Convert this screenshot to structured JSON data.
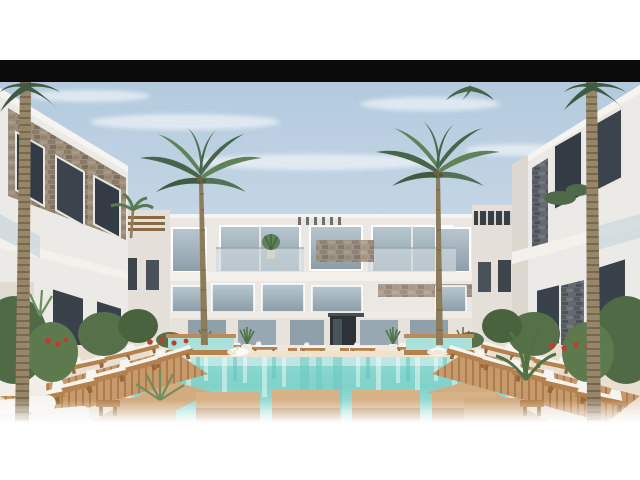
{
  "meta": {
    "kind": "architectural-render-photo",
    "description": "3D architectural rendering of a symmetrical white resort apartment complex around a turquoise swimming pool with wooden deck platforms, white sun loungers, tropical plants and tall palm trees under a pale blue sky. The image is letterboxed: white margins top and bottom and a solid black bar above the photo."
  },
  "palette": {
    "page_bg": "#ffffff",
    "letterbox": "#0b0b0b",
    "sky_top": "#b3cade",
    "sky_bottom": "#dfe8ee",
    "building_white": "#ebe8e3",
    "building_shade": "#dcd7cf",
    "stone_brown": "#9c8d7c",
    "stone_gray": "#5e6268",
    "glass": "#a9b9c3",
    "window_dark": "#333c44",
    "entry_dark": "#2c3237",
    "pool_main": "#7fd2ca",
    "pool_light": "#b9e9e2",
    "deck_wood": "#d3ab80",
    "deck_wood_front": "#bd9166",
    "bench_wood": "#b5824f",
    "ground_sand": "#e9dfd0",
    "cushion_white": "#f6f4ef",
    "palm_green_dark": "#46654a",
    "palm_green": "#5f8257",
    "trunk_brown": "#97876a",
    "flower_red": "#c23b2e"
  },
  "scene": {
    "labels": {
      "page": "letterboxed resort rendering",
      "letterbox_top": "black letterbox bar",
      "sky": "pale blue sky with thin clouds",
      "center_building": "central three-storey white apartment building with glass balconies",
      "left_building": "left white building with brown stone cladding",
      "right_building": "right white building with gray stone accents",
      "pool": "turquoise swimming pool with cascade water features",
      "deck": "wooden stepping platforms over the pool",
      "loungers_left": "fan of white sun loungers on wooden deck, left side",
      "loungers_right": "fan of white sun loungers on wooden deck, right side",
      "loungers_far": "row of sun loungers along the far pool edge",
      "palm_left_edge": "tall palm trunk at left edge",
      "palm_right_edge": "tall palm trunk at right edge",
      "palm_center_left": "palm tree left of building center",
      "palm_center_right": "palm tree right of building center",
      "plants_left": "tropical plants with red flowers, left side",
      "plants_right": "tropical plants with red flowers, right side",
      "towels": "white rolled towels near bottom left"
    }
  }
}
